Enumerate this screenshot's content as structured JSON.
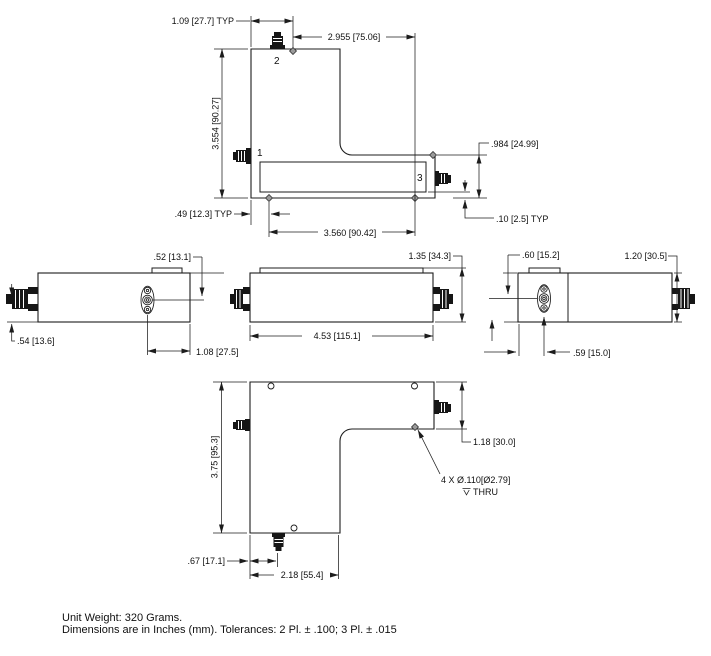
{
  "drawing": {
    "background": "#ffffff",
    "ink": "#1c1c1c",
    "views": {
      "top": {
        "ports": {
          "p1": "1",
          "p2": "2",
          "p3": "3"
        },
        "dims": {
          "typ_left": "1.09 [27.7] TYP",
          "top_width": "2.955 [75.06]",
          "height": "3.554 [90.27]",
          "arm_height": ".984 [24.99]",
          "edge_typ": ".10 [2.5] TYP",
          "hole_offset_typ": ".49 [12.3] TYP",
          "hole_span": "3.560 [90.42]"
        }
      },
      "side_left": {
        "dims": {
          "tab": ".52 [13.1]",
          "conn_drop": ".54 [13.6]",
          "conn_offset": "1.08 [27.5]"
        }
      },
      "side_center": {
        "dims": {
          "height": "1.35 [34.3]",
          "length": "4.53 [115.1]"
        }
      },
      "side_right": {
        "dims": {
          "conn_top": ".60 [15.2]",
          "height": "1.20 [30.5]",
          "conn_offset": ".59 [15.0]"
        }
      },
      "bottom": {
        "dims": {
          "height": "3.75 [95.3]",
          "arm_height": "1.18 [30.0]",
          "conn_offset": ".67 [17.1]",
          "leg_width": "2.18 [55.4]"
        },
        "hole_note": {
          "line1": "4 X Ø.110[Ø2.79]",
          "line2": "THRU"
        }
      }
    },
    "notes": {
      "line1": "Unit Weight: 320 Grams.",
      "line2": "Dimensions are in Inches (mm). Tolerances: 2 Pl. ± .100; 3 Pl. ± .015"
    }
  }
}
